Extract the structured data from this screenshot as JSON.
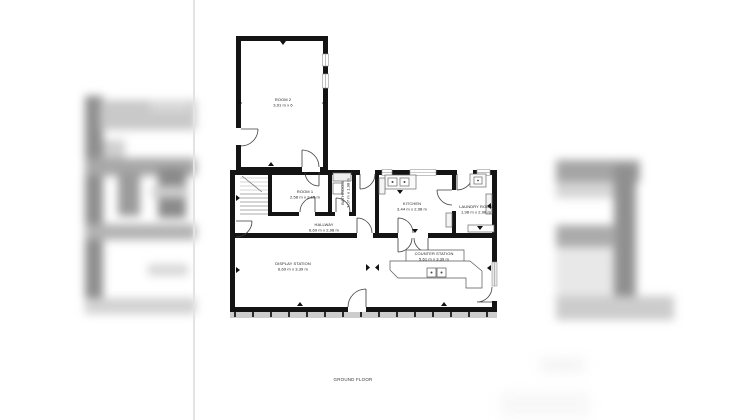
{
  "floor": {
    "label": "GROUND FLOOR"
  },
  "rooms": {
    "room2": {
      "name": "ROOM 2",
      "dims": "3,91 m x 6"
    },
    "room1": {
      "name": "ROOM 1",
      "dims": "2,58 m x 2,15 m"
    },
    "bathroom": {
      "name": "BATHROOM",
      "dims": "1,07 m x 1,98 m"
    },
    "hallway": {
      "name": "HALLWAY",
      "dims": "6,69 m x 2,98 m"
    },
    "kitchen": {
      "name": "KITCHEN",
      "dims": "3,44 m x 2,98 m"
    },
    "laundry": {
      "name": "LAUNDRY ROOM",
      "dims": "1,98 m x 2,98 m"
    },
    "display": {
      "name": "DISPLAY STATION",
      "dims": "6,69 m x 3,39 m"
    },
    "counter": {
      "name": "COUNTER STATION",
      "dims": "5,61 m x 3,39 m"
    }
  },
  "colors": {
    "wall": "#141414",
    "door_stroke": "#3d3d3d",
    "fixture_stroke": "#6a6a6a",
    "hatch_strip": "#cdcdcd",
    "page_edge": "#e3e3e3",
    "background": "#ffffff"
  }
}
